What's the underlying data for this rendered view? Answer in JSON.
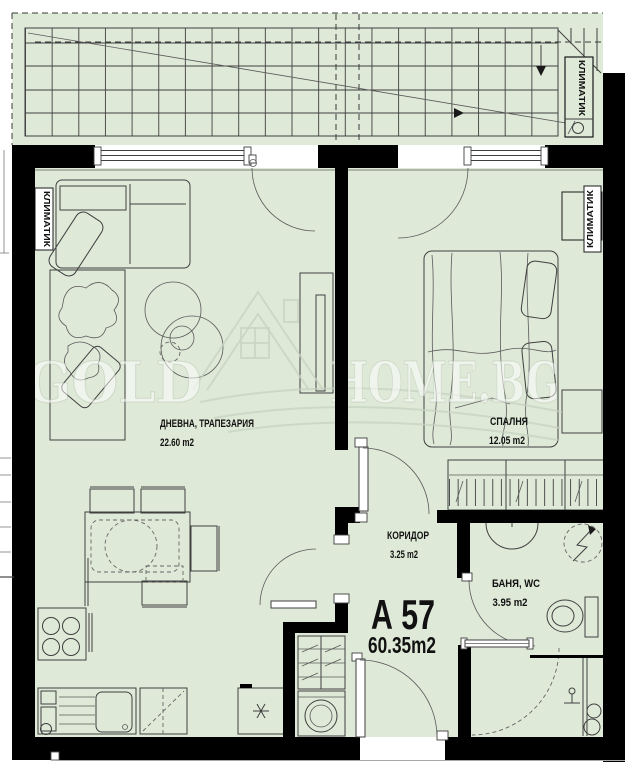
{
  "plan": {
    "apartment_id": "А 57",
    "apartment_area": "60.35m2",
    "rooms": [
      {
        "name": "ДНЕВНА, ТРАПЕЗАРИЯ",
        "area": "22.60 m2"
      },
      {
        "name": "СПАЛНЯ",
        "area": "12.05 m2"
      },
      {
        "name": "КОРИДОР",
        "area": "3.25 m2"
      },
      {
        "name": "БАНЯ, WC",
        "area": "3.95 m2"
      }
    ],
    "ac_label": "КЛИМАТИК",
    "watermark": {
      "gold": "GOLD",
      "home": "HOME.BG"
    },
    "colors": {
      "floor": "#dfe9d8",
      "wall": "#000000",
      "line": "#3f3f3f"
    }
  }
}
